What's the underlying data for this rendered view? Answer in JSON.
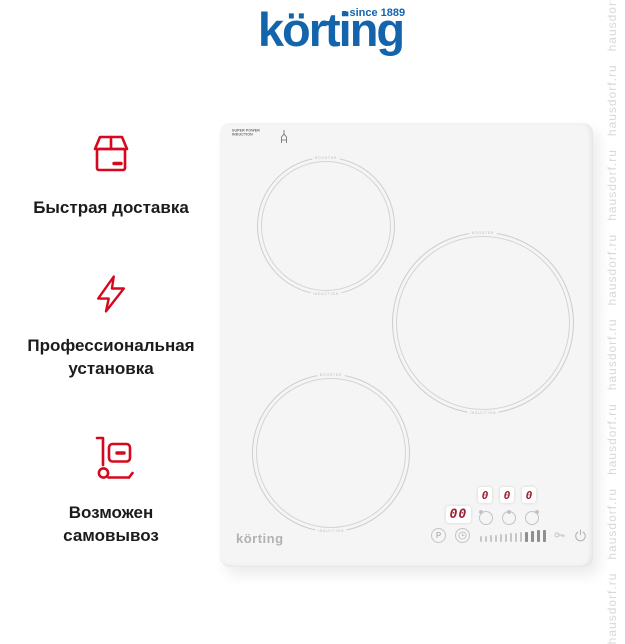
{
  "brand": {
    "logo": "körting",
    "tagline": "since 1889",
    "blue": "#1464ac"
  },
  "features": [
    {
      "icon": "package-icon",
      "lines": [
        "Быстрая доставка"
      ]
    },
    {
      "icon": "bolt-icon",
      "lines": [
        "Профессиональная",
        "установка"
      ]
    },
    {
      "icon": "handtruck-icon",
      "lines": [
        "Возможен",
        "самовывоз"
      ]
    }
  ],
  "product": {
    "corner_badge": {
      "line1": "SUPER POWER",
      "line2": "INDUCTION"
    },
    "brand_label": "körting",
    "zones": [
      {
        "top_label": "BOOSTER",
        "bottom_label": "INDUCTION"
      },
      {
        "top_label": "BOOSTER",
        "bottom_label": "INDUCTION"
      },
      {
        "top_label": "BOOSTER",
        "bottom_label": "INDUCTION"
      }
    ],
    "control_panel": {
      "timer_display": "00",
      "zone_displays": [
        "0",
        "0",
        "0"
      ],
      "boost_label": "P",
      "slider": {
        "ticks": 13,
        "active_from": 10
      },
      "segment_color": "#9e2033"
    }
  },
  "watermark": {
    "text": "hausdorf.ru",
    "repeated": "hausdorf.ru   hausdorf.ru   hausdorf.ru   hausdorf.ru   hausdorf.ru   hausdorf.ru   hausdorf.ru   hausdorf.ru"
  },
  "colors": {
    "accent_red": "#d6081e",
    "logo_blue": "#1464ac",
    "hob_surface": "#f5f5f6"
  }
}
